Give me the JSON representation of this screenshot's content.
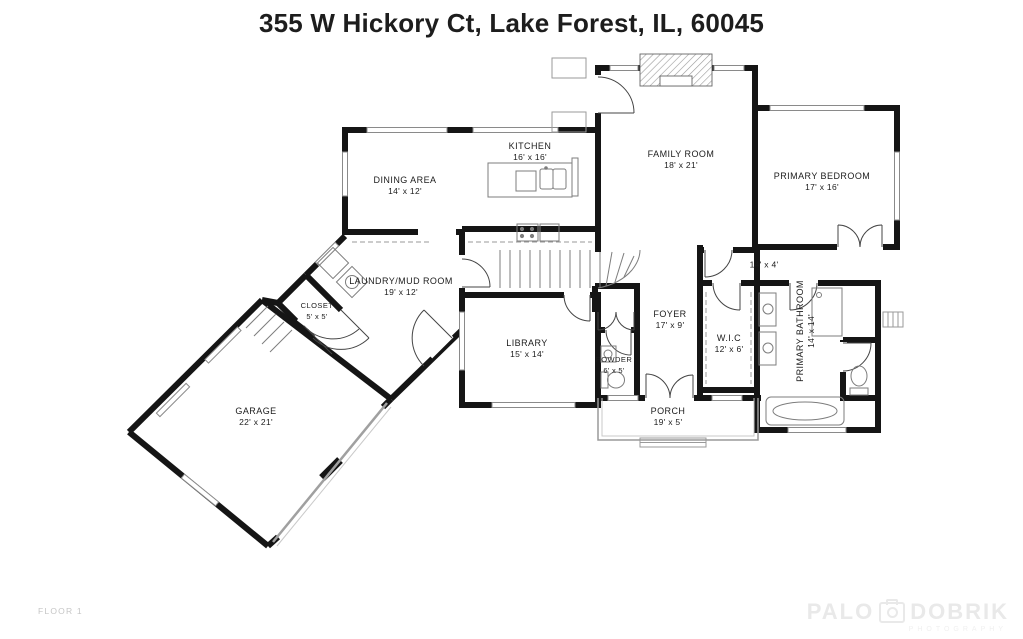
{
  "title": "355 W Hickory Ct, Lake Forest, IL, 60045",
  "floor_label": "FLOOR 1",
  "watermark": {
    "brand_first": "PALO",
    "brand_second": "DOBRIK",
    "tagline": "PHOTOGRAPHY",
    "camera_icon": "camera-icon"
  },
  "colors": {
    "wall": "#151515",
    "window": "#8a8a8a",
    "fixture": "#7d7d7d",
    "dashed": "#9a9a9a",
    "text": "#1c1c1c",
    "muted": "#c6c6c6",
    "watermark": "#e9e9e9",
    "background": "#ffffff"
  },
  "rooms": [
    {
      "id": "kitchen",
      "name": "KITCHEN",
      "dims": "16' x 16'"
    },
    {
      "id": "dining-area",
      "name": "DINING AREA",
      "dims": "14' x 12'"
    },
    {
      "id": "family-room",
      "name": "FAMILY ROOM",
      "dims": "18' x 21'"
    },
    {
      "id": "primary-bedroom",
      "name": "PRIMARY BEDROOM",
      "dims": "17' x 16'"
    },
    {
      "id": "laundry-mud-room",
      "name": "LAUNDRY/MUD ROOM",
      "dims": "19' x 12'"
    },
    {
      "id": "closet",
      "name": "CLOSET",
      "dims": "5' x 5'"
    },
    {
      "id": "library",
      "name": "LIBRARY",
      "dims": "15' x 14'"
    },
    {
      "id": "powder",
      "name": "POWDER",
      "dims": "6' x 5'"
    },
    {
      "id": "foyer",
      "name": "FOYER",
      "dims": "17' x 9'"
    },
    {
      "id": "hallway",
      "name": "",
      "dims": "14' x 4'"
    },
    {
      "id": "wic",
      "name": "W.I.C",
      "dims": "12' x 6'"
    },
    {
      "id": "primary-bathroom",
      "name": "PRIMARY BATHROOM",
      "dims": "14' x 14'"
    },
    {
      "id": "porch",
      "name": "PORCH",
      "dims": "19' x 5'"
    },
    {
      "id": "garage",
      "name": "GARAGE",
      "dims": "22' x 21'"
    }
  ]
}
